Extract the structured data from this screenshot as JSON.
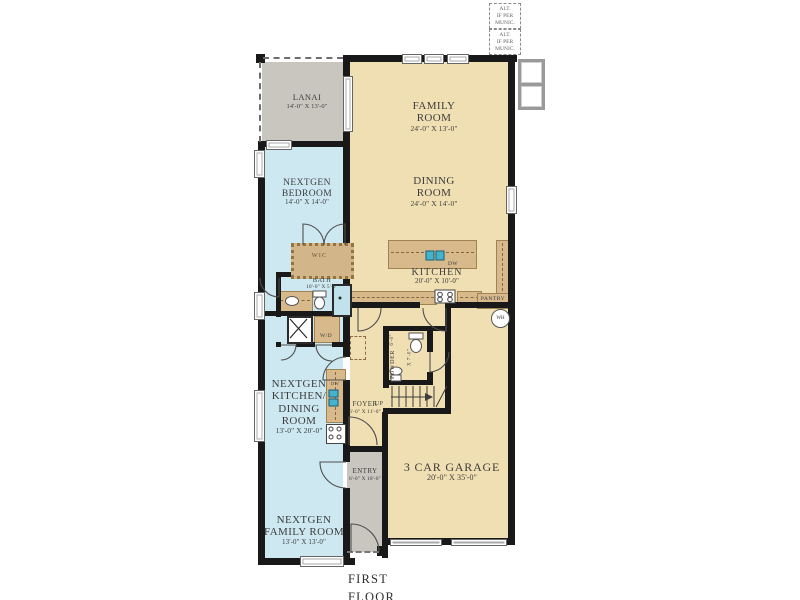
{
  "meta": {
    "caption": "FIRST FLOOR"
  },
  "annotations": {
    "alt_note_1": {
      "l1": "ALT.",
      "l2": "IF PER",
      "l3": "MUNIC."
    },
    "alt_note_2": {
      "l1": "ALT.",
      "l2": "IF PER",
      "l3": "MUNIC."
    }
  },
  "rooms": {
    "lanai": {
      "name": "LANAI",
      "dims": "14'-0\" X 13'-0\""
    },
    "family_room": {
      "name": "FAMILY ROOM",
      "dims": "24'-0\" X 13'-0\""
    },
    "dining_room": {
      "name": "DINING ROOM",
      "dims": "24'-0\" X 14'-0\""
    },
    "nextgen_bedroom": {
      "name": "NEXTGEN BEDROOM",
      "dims": "14'-0\" X 14'-0\""
    },
    "wic": {
      "name": "WIC"
    },
    "bath": {
      "name": "BATH",
      "dims": "10'-0\" X 5'-0\""
    },
    "kitchen": {
      "name": "KITCHEN",
      "dims": "20'-0\" X 10'-0\""
    },
    "pantry": {
      "name": "PANTRY"
    },
    "powder": {
      "name": "POWDER",
      "dims": "6'-0\" X 7'-0\""
    },
    "foyer": {
      "name": "FOYER",
      "dims": "6'-0\" X 11'-0\""
    },
    "nextgen_kitchen_dining": {
      "l1": "NEXTGEN",
      "l2": "KITCHEN/",
      "l3": "DINING",
      "l4": "ROOM",
      "dims": "13'-0\" X 20'-0\""
    },
    "entry": {
      "name": "ENTRY",
      "dims": "6'-0\" X 18'-0\""
    },
    "garage": {
      "name": "3 CAR GARAGE",
      "dims": "20'-0\" X 35'-0\""
    },
    "nextgen_family_room": {
      "name": "NEXTGEN FAMILY ROOM",
      "dims": "13'-0\" X 13'-0\""
    }
  },
  "fixtures": {
    "dishwasher_main": "DW",
    "dishwasher_nextgen": "DW",
    "washer_dryer": "W/D",
    "water_heater": "WH",
    "stairs_up": "UP"
  },
  "colors": {
    "main_area": "#f0dfb2",
    "nextgen_area": "#cde8f1",
    "outdoor_area": "#c9c6c0",
    "wall": "#191919",
    "cabinet": "#d7b98c",
    "plumbing": "#45b3cc"
  }
}
